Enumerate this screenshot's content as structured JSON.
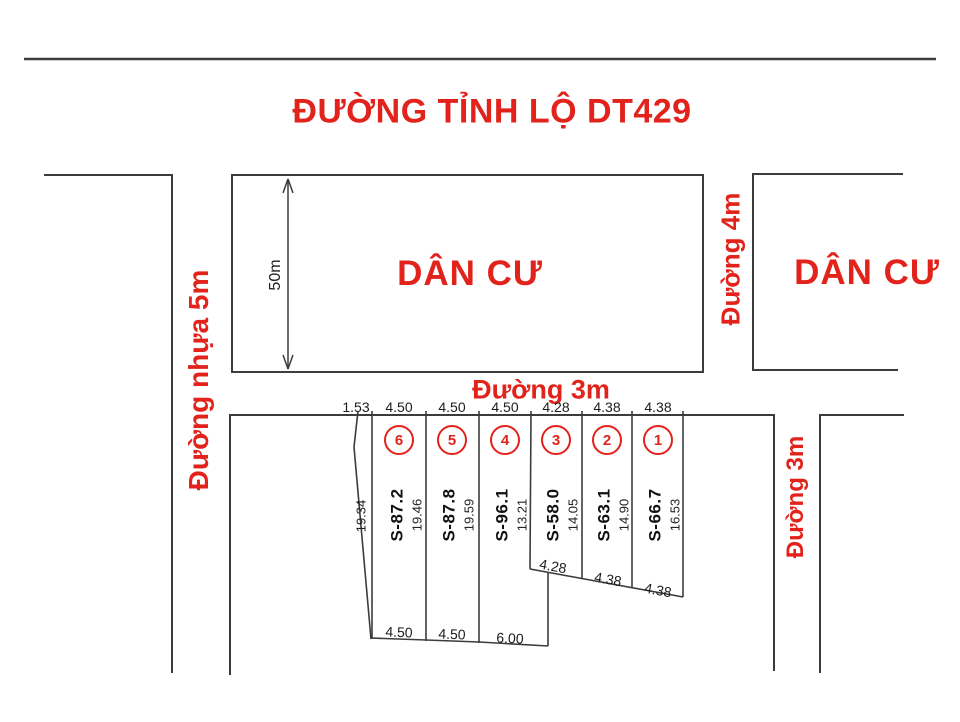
{
  "title": "ĐƯỜNG TỈNH LỘ DT429",
  "labels": {
    "road_left": "Đường nhựa 5m",
    "road_middle": "Đường 3m",
    "road_right_top": "Đường 4m",
    "road_right_bottom": "Đường 3m",
    "residential_left": "DÂN CƯ",
    "residential_right": "DÂN CƯ",
    "depth_dim": "50m",
    "left_edge_dim": "19.34"
  },
  "top_measurements": [
    "1.53",
    "4.50",
    "4.50",
    "4.50",
    "4.28",
    "4.38",
    "4.38"
  ],
  "plots": [
    {
      "number": "6",
      "area_label": "S-87.2",
      "side_length": "19.46"
    },
    {
      "number": "5",
      "area_label": "S-87.8",
      "side_length": "19.59"
    },
    {
      "number": "4",
      "area_label": "S-96.1",
      "side_length": "13.21"
    },
    {
      "number": "3",
      "area_label": "S-58.0",
      "side_length": "14.05"
    },
    {
      "number": "2",
      "area_label": "S-63.1",
      "side_length": "14.90"
    },
    {
      "number": "1",
      "area_label": "S-66.7",
      "side_length": "16.53"
    }
  ],
  "diagonal_measurements": [
    "4.28",
    "4.38",
    "4.38"
  ],
  "bottom_measurements": [
    "4.50",
    "4.50",
    "6.00"
  ],
  "colors": {
    "accent_red": "#e2231c",
    "line_color": "#3c3c3c",
    "dim_text": "#1c1c1c"
  }
}
